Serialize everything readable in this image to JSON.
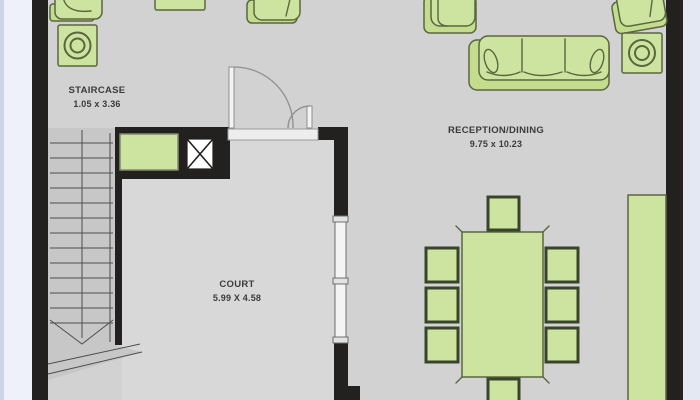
{
  "document": {
    "type": "architectural floor plan"
  },
  "rooms": {
    "staircase": {
      "name": "STAIRCASE",
      "dims": "1.05 x 3.36"
    },
    "reception": {
      "name": "RECEPTION/DINING",
      "dims": "9.75 x 10.23"
    },
    "court": {
      "name": "COURT",
      "dims": "5.99 X 4.58"
    }
  },
  "furniture": [
    "sink-unit",
    "washing-machine",
    "small-side-table",
    "armchair-top-center",
    "armchair-left-of-sofa",
    "sofa-3-seat",
    "armchair-corner",
    "round-side-table",
    "sideboard-right-wall",
    "storage-cabinet-by-stairs",
    "dining-table",
    "dining-chairs-count-8",
    "staircase-with-direction-arrow",
    "double-swing-door",
    "window-3-panel",
    "shaft-duct-symbol"
  ],
  "colors": {
    "wall": "#23211f",
    "floor": "#d2d2d2",
    "court_floor": "#d8d8d8",
    "stair": "#c7c7c7",
    "stair_line": "#4d4d4d",
    "furniture_fill": "#cde4a0",
    "furniture_base": "#c3dc8e",
    "furniture_stroke": "#5a663e",
    "furniture_dark": "#39452a",
    "cabinet_stroke": "#838a6d",
    "door_line": "#8f8f8f",
    "window_frame": "#6f6f6f",
    "bg_left": "#eef1f9",
    "bg_right": "#e4e8f2",
    "bg_edge": "#ccd4e8",
    "text": "#3b3b3b"
  }
}
